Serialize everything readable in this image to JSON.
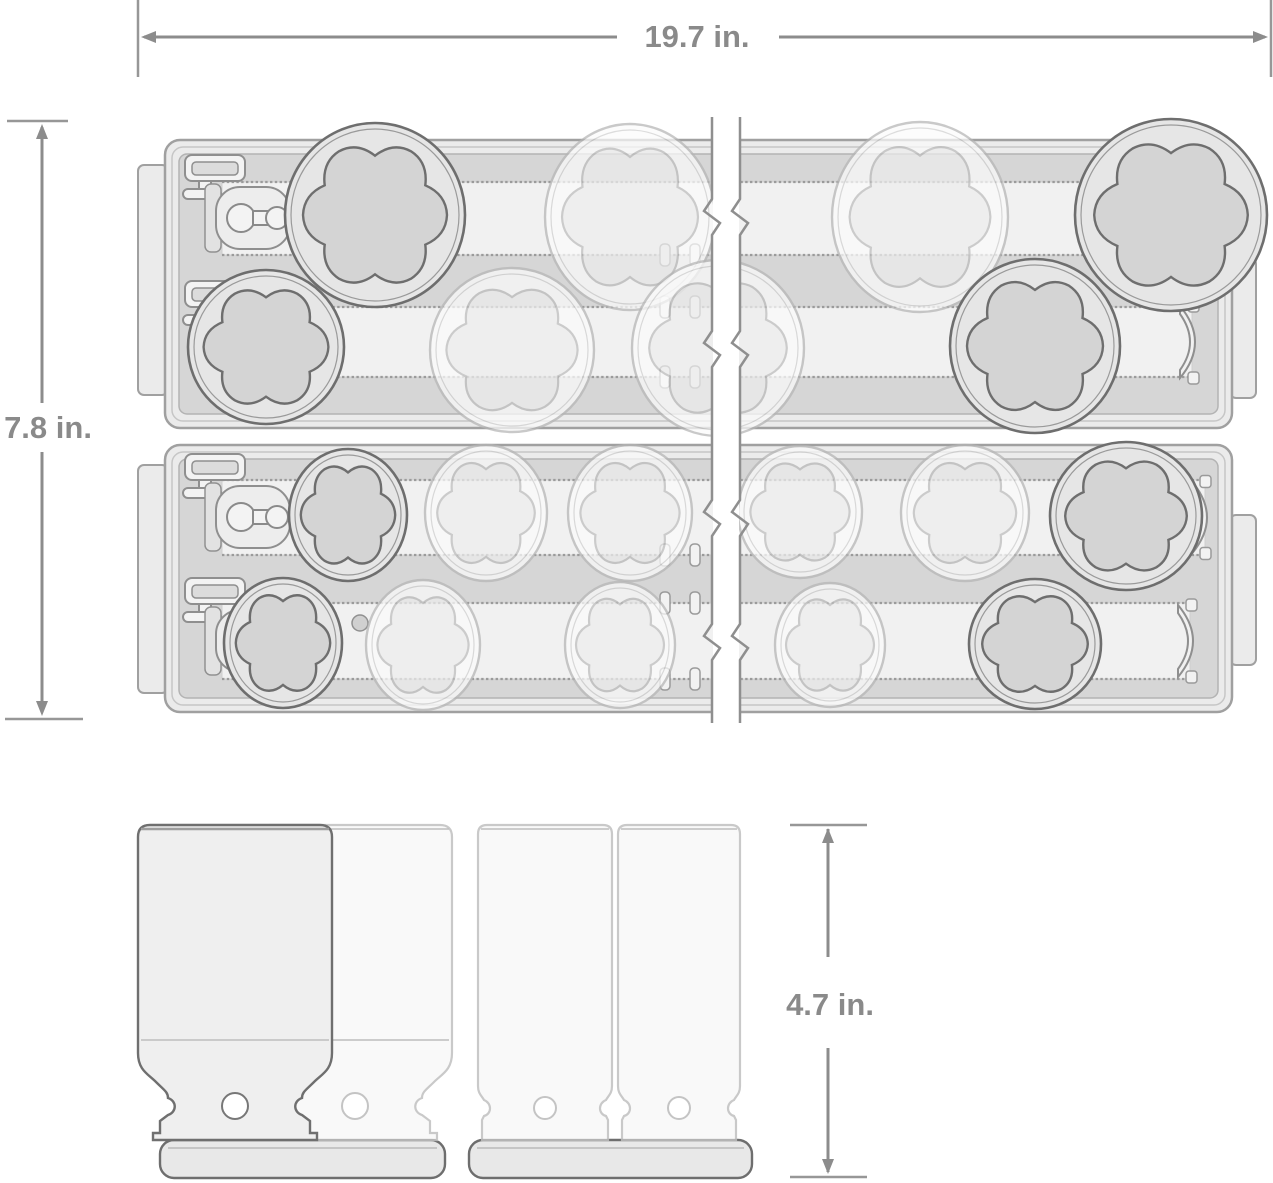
{
  "diagram": {
    "subject": "impact socket set with two storage trays (top view) and deep sockets (side view)",
    "style": "technical line drawing with break lines",
    "dimensions": {
      "width": {
        "label": "19.7 in."
      },
      "height": {
        "label": "7.8 in."
      },
      "socket_height": {
        "label": "4.7 in."
      }
    },
    "colors": {
      "background": "#ffffff",
      "dimension_gray": "#8c8c8c",
      "label_gray": "#8a8a8a",
      "outline_dark": "#6e6e6e",
      "outline_mid": "#9b9b9b",
      "outline_ghost": "#bdbdbd",
      "fill_shell": "#ebebeb",
      "fill_floor": "#d6d6d6",
      "fill_rail": "#f1f1f1",
      "fill_socket": "#d4d4d4"
    },
    "figures": {
      "break": {
        "x1": 712,
        "x2": 740,
        "y1": 117,
        "y2": 723,
        "jogs": [
          216,
          348,
          517,
          641
        ]
      },
      "trays": [
        {
          "name": "tray-top",
          "x": 165,
          "y": 140,
          "w": 1067,
          "h": 288,
          "left_tab": {
            "x": 138,
            "y": 165,
            "w": 30,
            "h": 230
          },
          "right_tab": {
            "x": 1230,
            "y": 258,
            "w": 26,
            "h": 140
          },
          "clip_pairs": {
            "x": 660,
            "x2": 690,
            "edges": [
              255,
              307,
              377
            ]
          },
          "pin": null,
          "rails": [
            {
              "y1": 182,
              "y2": 255,
              "x1": 222,
              "x2": 1210,
              "lc": 218,
              "bracket": null,
              "sockets": [
                {
                  "cx": 375,
                  "cy": 215,
                  "rx": 90,
                  "ry": 92,
                  "style": "solid"
                },
                {
                  "cx": 630,
                  "cy": 217,
                  "rx": 85,
                  "ry": 93,
                  "style": "ghost"
                },
                {
                  "cx": 920,
                  "cy": 217,
                  "rx": 88,
                  "ry": 95,
                  "style": "ghost"
                },
                {
                  "cx": 1171,
                  "cy": 215,
                  "rx": 96,
                  "ry": 96,
                  "style": "solid"
                }
              ]
            },
            {
              "y1": 307,
              "y2": 377,
              "x1": 222,
              "x2": 1192,
              "lc": 344,
              "bracket": 1180,
              "sockets": [
                {
                  "cx": 266,
                  "cy": 347,
                  "rx": 78,
                  "ry": 77,
                  "style": "solid"
                },
                {
                  "cx": 512,
                  "cy": 350,
                  "rx": 82,
                  "ry": 82,
                  "style": "ghost"
                },
                {
                  "cx": 718,
                  "cy": 348,
                  "rx": 86,
                  "ry": 88,
                  "style": "ghost"
                },
                {
                  "cx": 1035,
                  "cy": 346,
                  "rx": 85,
                  "ry": 87,
                  "style": "solid"
                }
              ]
            }
          ]
        },
        {
          "name": "tray-bottom",
          "x": 165,
          "y": 445,
          "w": 1067,
          "h": 267,
          "left_tab": {
            "x": 138,
            "y": 465,
            "w": 30,
            "h": 228
          },
          "right_tab": {
            "x": 1230,
            "y": 515,
            "w": 26,
            "h": 150
          },
          "clip_pairs": {
            "x": 660,
            "x2": 690,
            "edges": [
              555,
              603,
              679
            ]
          },
          "pin": {
            "cx": 360,
            "cy": 623,
            "r": 8
          },
          "rails": [
            {
              "y1": 480,
              "y2": 555,
              "x1": 222,
              "x2": 1205,
              "lc": 517,
              "bracket": 1192,
              "sockets": [
                {
                  "cx": 348,
                  "cy": 515,
                  "rx": 59,
                  "ry": 66,
                  "style": "solid"
                },
                {
                  "cx": 486,
                  "cy": 513,
                  "rx": 61,
                  "ry": 68,
                  "style": "ghost"
                },
                {
                  "cx": 630,
                  "cy": 513,
                  "rx": 62,
                  "ry": 68,
                  "style": "ghost"
                },
                {
                  "cx": 800,
                  "cy": 512,
                  "rx": 62,
                  "ry": 66,
                  "style": "ghost"
                },
                {
                  "cx": 965,
                  "cy": 513,
                  "rx": 64,
                  "ry": 68,
                  "style": "ghost"
                },
                {
                  "cx": 1126,
                  "cy": 516,
                  "rx": 76,
                  "ry": 74,
                  "style": "solid"
                }
              ]
            },
            {
              "y1": 603,
              "y2": 679,
              "x1": 222,
              "x2": 1190,
              "lc": 641,
              "bracket": 1178,
              "sockets": [
                {
                  "cx": 283,
                  "cy": 643,
                  "rx": 59,
                  "ry": 65,
                  "style": "solid"
                },
                {
                  "cx": 423,
                  "cy": 645,
                  "rx": 57,
                  "ry": 65,
                  "style": "ghost"
                },
                {
                  "cx": 620,
                  "cy": 645,
                  "rx": 55,
                  "ry": 63,
                  "style": "ghost"
                },
                {
                  "cx": 830,
                  "cy": 645,
                  "rx": 55,
                  "ry": 62,
                  "style": "ghost"
                },
                {
                  "cx": 1035,
                  "cy": 644,
                  "rx": 66,
                  "ry": 65,
                  "style": "solid"
                }
              ]
            }
          ]
        }
      ],
      "side_view": {
        "top": 825,
        "bottom": 1140,
        "bases": [
          {
            "x": 160,
            "w": 285
          },
          {
            "x": 469,
            "w": 283
          }
        ],
        "base_y": 1140,
        "base_h": 38,
        "sockets": [
          {
            "x": 258,
            "w": 194,
            "kind": "large",
            "style": "ghost"
          },
          {
            "x": 138,
            "w": 194,
            "kind": "large",
            "style": "solid"
          },
          {
            "x": 478,
            "w": 134,
            "kind": "slim",
            "style": "ghost"
          },
          {
            "x": 618,
            "w": 122,
            "kind": "slim",
            "style": "ghost"
          }
        ]
      },
      "annotations": {
        "width": {
          "ext_x": [
            138,
            1271
          ],
          "ext_y1": 0,
          "ext_y2": 77,
          "line_y": 37,
          "segs": [
            [
              144,
              617
            ],
            [
              779,
              1265
            ]
          ],
          "text_x": 697,
          "text_y": 47
        },
        "height": {
          "ext_y": [
            121,
            719
          ],
          "line_x": 42,
          "segs": [
            [
              127,
              403
            ],
            [
              452,
              712
            ]
          ],
          "text_x": 48,
          "text_y": 438
        },
        "socket_height": {
          "ext_y": [
            825,
            1177
          ],
          "ext_x1": 790,
          "ext_x2": 867,
          "line_x": 828,
          "segs": [
            [
              829,
              957
            ],
            [
              1048,
              1172
            ]
          ],
          "text_x": 830,
          "text_y": 1015
        }
      }
    }
  }
}
